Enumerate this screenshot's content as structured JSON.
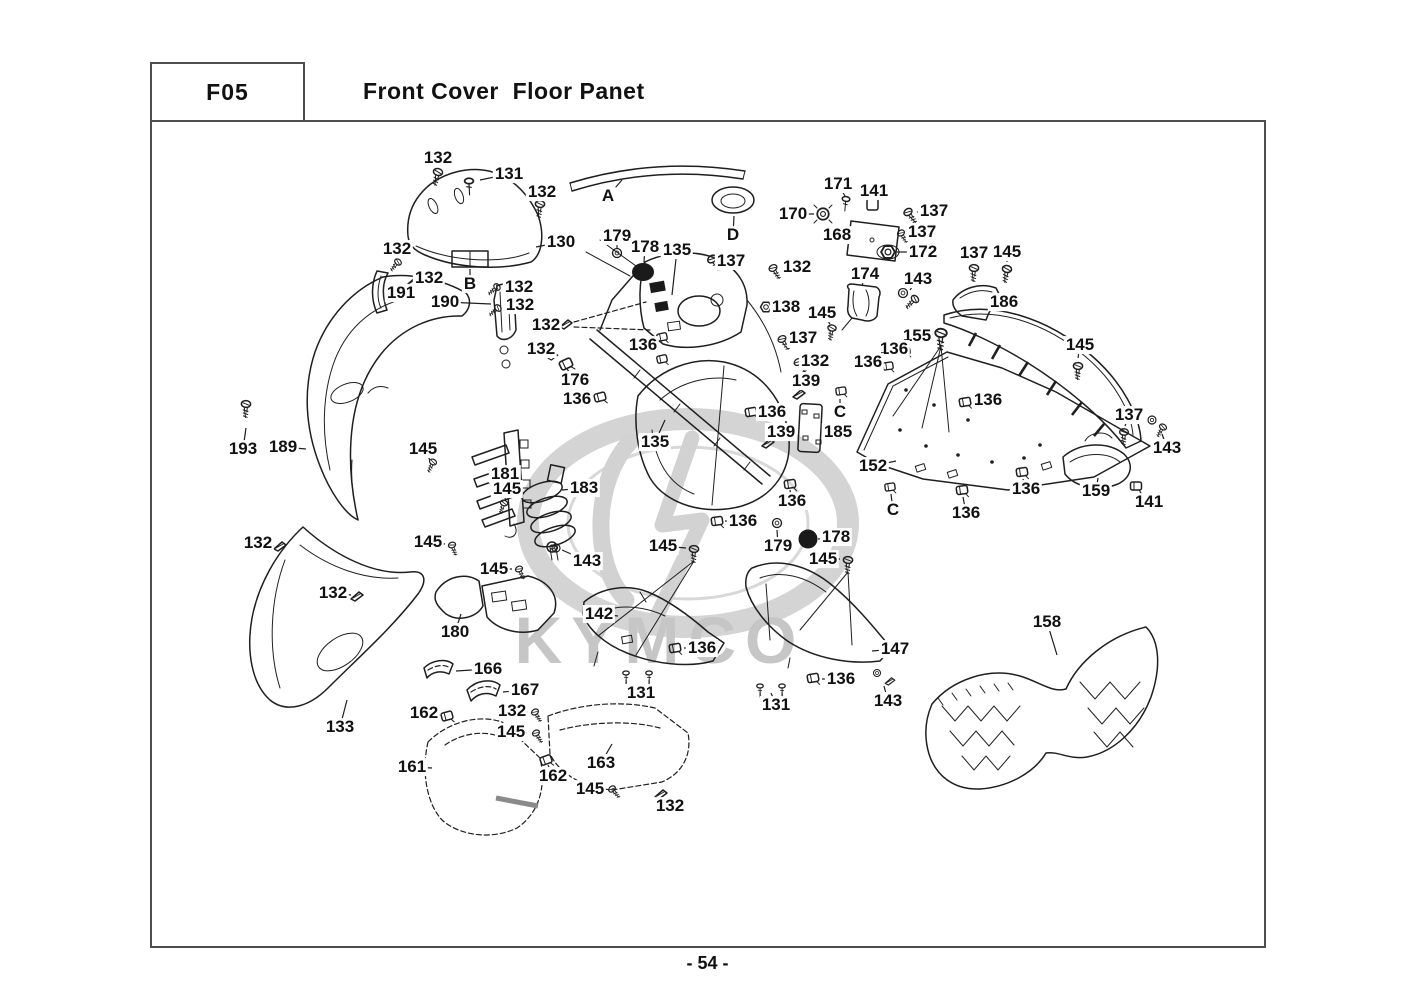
{
  "title_block": {
    "code": "F05",
    "title": "Front Cover  Floor Panet"
  },
  "page_number": "- 54 -",
  "watermark": {
    "text": "KYMCO",
    "color": "#c6c6c6",
    "ring_color": "#d4d4d4"
  },
  "figure": {
    "section_letters": [
      "A",
      "B",
      "C",
      "D"
    ],
    "part_numbers": [
      "130",
      "131",
      "132",
      "133",
      "135",
      "136",
      "137",
      "138",
      "139",
      "141",
      "142",
      "143",
      "145",
      "147",
      "152",
      "155",
      "158",
      "159",
      "161",
      "162",
      "163",
      "166",
      "167",
      "168",
      "170",
      "171",
      "172",
      "174",
      "176",
      "178",
      "179",
      "180",
      "181",
      "183",
      "185",
      "186",
      "189",
      "190",
      "191",
      "193"
    ]
  },
  "labels": [
    {
      "t": "132",
      "x": 438,
      "y": 158,
      "lx": 438,
      "ly": 167
    },
    {
      "t": "131",
      "x": 509,
      "y": 174,
      "lx": 480,
      "ly": 180
    },
    {
      "t": "132",
      "x": 542,
      "y": 192,
      "lx": 541,
      "ly": 200
    },
    {
      "t": "A",
      "x": 608,
      "y": 196,
      "lx": 622,
      "ly": 180
    },
    {
      "t": "D",
      "x": 733,
      "y": 235,
      "lx": 734,
      "ly": 216
    },
    {
      "t": "130",
      "x": 561,
      "y": 242,
      "lx": 536,
      "ly": 247
    },
    {
      "t": "179",
      "x": 617,
      "y": 236,
      "lx": 617,
      "ly": 249
    },
    {
      "t": "178",
      "x": 645,
      "y": 247,
      "lx": 644,
      "ly": 262
    },
    {
      "t": "135",
      "x": 677,
      "y": 250,
      "lx": 672,
      "ly": 295
    },
    {
      "t": "137",
      "x": 731,
      "y": 261,
      "lx": 718,
      "ly": 260
    },
    {
      "t": "171",
      "x": 838,
      "y": 184,
      "lx": 845,
      "ly": 196
    },
    {
      "t": "141",
      "x": 874,
      "y": 191,
      "lx": 873,
      "ly": 200
    },
    {
      "t": "170",
      "x": 793,
      "y": 214,
      "lx": 814,
      "ly": 214
    },
    {
      "t": "137",
      "x": 934,
      "y": 211,
      "lx": 917,
      "ly": 212
    },
    {
      "t": "168",
      "x": 837,
      "y": 235,
      "lx": 851,
      "ly": 238
    },
    {
      "t": "137",
      "x": 922,
      "y": 232,
      "lx": 908,
      "ly": 233
    },
    {
      "t": "172",
      "x": 923,
      "y": 252,
      "lx": 897,
      "ly": 252
    },
    {
      "t": "137",
      "x": 974,
      "y": 253,
      "lx": 974,
      "ly": 262
    },
    {
      "t": "145",
      "x": 1007,
      "y": 252,
      "lx": 1007,
      "ly": 262
    },
    {
      "t": "132",
      "x": 797,
      "y": 267,
      "lx": 782,
      "ly": 268
    },
    {
      "t": "174",
      "x": 865,
      "y": 274,
      "lx": 862,
      "ly": 286
    },
    {
      "t": "143",
      "x": 918,
      "y": 279,
      "lx": 910,
      "ly": 290
    },
    {
      "t": "186",
      "x": 1004,
      "y": 302,
      "lx": 988,
      "ly": 300
    },
    {
      "t": "155",
      "x": 917,
      "y": 336,
      "lx": 933,
      "ly": 334
    },
    {
      "t": "136",
      "x": 894,
      "y": 349,
      "lx": 905,
      "ly": 351
    },
    {
      "t": "136",
      "x": 868,
      "y": 362,
      "lx": 880,
      "ly": 364
    },
    {
      "t": "145",
      "x": 1080,
      "y": 345,
      "lx": 1078,
      "ly": 358
    },
    {
      "t": "132",
      "x": 397,
      "y": 249,
      "lx": 398,
      "ly": 257
    },
    {
      "t": "132",
      "x": 429,
      "y": 278,
      "lx": 420,
      "ly": 280
    },
    {
      "t": "191",
      "x": 401,
      "y": 293,
      "lx": 388,
      "ly": 288
    },
    {
      "t": "B",
      "x": 470,
      "y": 284,
      "lx": 470,
      "ly": 269
    },
    {
      "t": "132",
      "x": 519,
      "y": 287,
      "lx": 505,
      "ly": 287
    },
    {
      "t": "190",
      "x": 445,
      "y": 302,
      "lx": 491,
      "ly": 304
    },
    {
      "t": "132",
      "x": 520,
      "y": 305,
      "lx": 506,
      "ly": 307
    },
    {
      "t": "132",
      "x": 546,
      "y": 325,
      "lx": 560,
      "ly": 325
    },
    {
      "t": "138",
      "x": 786,
      "y": 307,
      "lx": 773,
      "ly": 307
    },
    {
      "t": "145",
      "x": 822,
      "y": 313,
      "lx": 830,
      "ly": 324
    },
    {
      "t": "132",
      "x": 541,
      "y": 349,
      "lx": 553,
      "ly": 352
    },
    {
      "t": "136",
      "x": 643,
      "y": 345,
      "lx": 656,
      "ly": 341
    },
    {
      "t": "137",
      "x": 803,
      "y": 338,
      "lx": 790,
      "ly": 339
    },
    {
      "t": "132",
      "x": 815,
      "y": 361,
      "lx": 805,
      "ly": 362
    },
    {
      "t": "176",
      "x": 575,
      "y": 380,
      "lx": 567,
      "ly": 369
    },
    {
      "t": "139",
      "x": 806,
      "y": 381,
      "lx": 801,
      "ly": 391
    },
    {
      "t": "136",
      "x": 577,
      "y": 399,
      "lx": 592,
      "ly": 398
    },
    {
      "t": "136",
      "x": 772,
      "y": 412,
      "lx": 758,
      "ly": 412
    },
    {
      "t": "C",
      "x": 840,
      "y": 412,
      "lx": 840,
      "ly": 399
    },
    {
      "t": "139",
      "x": 781,
      "y": 432,
      "lx": 773,
      "ly": 440
    },
    {
      "t": "185",
      "x": 838,
      "y": 432,
      "lx": 824,
      "ly": 431
    },
    {
      "t": "135",
      "x": 655,
      "y": 442,
      "lx": 665,
      "ly": 420
    },
    {
      "t": "136",
      "x": 988,
      "y": 400,
      "lx": 973,
      "ly": 402
    },
    {
      "t": "137",
      "x": 1129,
      "y": 415,
      "lx": 1125,
      "ly": 426
    },
    {
      "t": "143",
      "x": 1167,
      "y": 448,
      "lx": 1162,
      "ly": 434
    },
    {
      "t": "152",
      "x": 873,
      "y": 466,
      "lx": 896,
      "ly": 461
    },
    {
      "t": "C",
      "x": 893,
      "y": 510,
      "lx": 891,
      "ly": 494
    },
    {
      "t": "136",
      "x": 966,
      "y": 513,
      "lx": 963,
      "ly": 497
    },
    {
      "t": "136",
      "x": 1026,
      "y": 489,
      "lx": 1023,
      "ly": 479
    },
    {
      "t": "159",
      "x": 1096,
      "y": 491,
      "lx": 1098,
      "ly": 478
    },
    {
      "t": "141",
      "x": 1149,
      "y": 502,
      "lx": 1140,
      "ly": 492
    },
    {
      "t": "193",
      "x": 243,
      "y": 449,
      "lx": 246,
      "ly": 428
    },
    {
      "t": "189",
      "x": 283,
      "y": 447,
      "lx": 306,
      "ly": 449
    },
    {
      "t": "145",
      "x": 423,
      "y": 449,
      "lx": 430,
      "ly": 460
    },
    {
      "t": "181",
      "x": 505,
      "y": 474,
      "lx": 490,
      "ly": 474
    },
    {
      "t": "145",
      "x": 507,
      "y": 489,
      "lx": 505,
      "ly": 499
    },
    {
      "t": "183",
      "x": 584,
      "y": 488,
      "lx": 562,
      "ly": 490
    },
    {
      "t": "132",
      "x": 258,
      "y": 543,
      "lx": 274,
      "ly": 546
    },
    {
      "t": "145",
      "x": 428,
      "y": 542,
      "lx": 445,
      "ly": 544
    },
    {
      "t": "145",
      "x": 494,
      "y": 569,
      "lx": 512,
      "ly": 569
    },
    {
      "t": "143",
      "x": 587,
      "y": 561,
      "lx": 562,
      "ly": 550
    },
    {
      "t": "136",
      "x": 792,
      "y": 501,
      "lx": 790,
      "ly": 490
    },
    {
      "t": "136",
      "x": 743,
      "y": 521,
      "lx": 725,
      "ly": 521
    },
    {
      "t": "179",
      "x": 778,
      "y": 546,
      "lx": 777,
      "ly": 530
    },
    {
      "t": "178",
      "x": 836,
      "y": 537,
      "lx": 818,
      "ly": 539
    },
    {
      "t": "145",
      "x": 823,
      "y": 559,
      "lx": 840,
      "ly": 559
    },
    {
      "t": "145",
      "x": 663,
      "y": 546,
      "lx": 686,
      "ly": 548
    },
    {
      "t": "132",
      "x": 333,
      "y": 593,
      "lx": 351,
      "ly": 595
    },
    {
      "t": "180",
      "x": 455,
      "y": 632,
      "lx": 461,
      "ly": 614
    },
    {
      "t": "166",
      "x": 488,
      "y": 669,
      "lx": 456,
      "ly": 671
    },
    {
      "t": "167",
      "x": 525,
      "y": 690,
      "lx": 503,
      "ly": 692
    },
    {
      "t": "162",
      "x": 424,
      "y": 713,
      "lx": 440,
      "ly": 715
    },
    {
      "t": "132",
      "x": 512,
      "y": 711,
      "lx": 528,
      "ly": 712
    },
    {
      "t": "145",
      "x": 511,
      "y": 732,
      "lx": 527,
      "ly": 733
    },
    {
      "t": "133",
      "x": 340,
      "y": 727,
      "lx": 347,
      "ly": 700
    },
    {
      "t": "142",
      "x": 599,
      "y": 614,
      "lx": 618,
      "ly": 616
    },
    {
      "t": "136",
      "x": 702,
      "y": 648,
      "lx": 684,
      "ly": 648
    },
    {
      "t": "131",
      "x": 641,
      "y": 693,
      "lx": 638,
      "ly": 687
    },
    {
      "t": "131",
      "x": 776,
      "y": 705,
      "lx": 771,
      "ly": 693
    },
    {
      "t": "147",
      "x": 895,
      "y": 649,
      "lx": 872,
      "ly": 651
    },
    {
      "t": "136",
      "x": 841,
      "y": 679,
      "lx": 822,
      "ly": 679
    },
    {
      "t": "143",
      "x": 888,
      "y": 701,
      "lx": 884,
      "ly": 686
    },
    {
      "t": "158",
      "x": 1047,
      "y": 622,
      "lx": 1057,
      "ly": 655
    },
    {
      "t": "161",
      "x": 412,
      "y": 767,
      "lx": 432,
      "ly": 768
    },
    {
      "t": "162",
      "x": 553,
      "y": 776,
      "lx": 548,
      "ly": 765
    },
    {
      "t": "163",
      "x": 601,
      "y": 763,
      "lx": 612,
      "ly": 744
    },
    {
      "t": "145",
      "x": 590,
      "y": 789,
      "lx": 605,
      "ly": 789
    },
    {
      "t": "132",
      "x": 670,
      "y": 806,
      "lx": 663,
      "ly": 798
    }
  ]
}
